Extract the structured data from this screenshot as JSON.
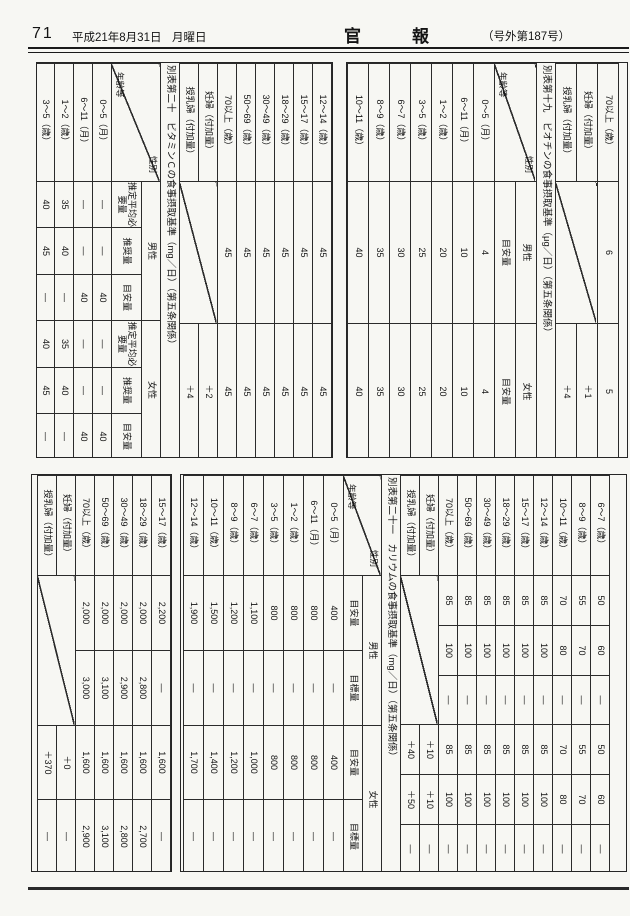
{
  "header": {
    "page_number": "71",
    "date": "平成21年8月31日",
    "weekday": "月曜日",
    "gazette_title": "官　　　報",
    "issue": "（号外第187号）"
  },
  "tables": {
    "pantothenic_tail": {
      "rows": [
        [
          "70以上（歳）",
          "6",
          "5"
        ],
        [
          "妊婦（付加量）",
          "DIAG",
          "＋1"
        ],
        [
          "授乳婦（付加量）",
          null,
          "＋4"
        ]
      ]
    },
    "biotin": {
      "title": "別表第十九　ビオチンの食事摂取基準（μg／日）（第五条関係）",
      "corner_top": "性別",
      "corner_bottom": "年齢等",
      "groups": [
        {
          "label": "男性",
          "cols": [
            "目安量"
          ]
        },
        {
          "label": "女性",
          "cols": [
            "目安量"
          ]
        }
      ],
      "part1_rows": [
        [
          "0～5（月）",
          "4",
          "4"
        ],
        [
          "6～11（月）",
          "10",
          "10"
        ],
        [
          "1～2（歳）",
          "20",
          "20"
        ],
        [
          "3～5（歳）",
          "25",
          "25"
        ],
        [
          "6～7（歳）",
          "30",
          "30"
        ],
        [
          "8～9（歳）",
          "35",
          "35"
        ],
        [
          "10～11（歳）",
          "40",
          "40"
        ]
      ],
      "part2_rows": [
        [
          "12～14（歳）",
          "45",
          "45"
        ],
        [
          "15～17（歳）",
          "45",
          "45"
        ],
        [
          "18～29（歳）",
          "45",
          "45"
        ],
        [
          "30～49（歳）",
          "45",
          "45"
        ],
        [
          "50～69（歳）",
          "45",
          "45"
        ],
        [
          "70以上（歳）",
          "45",
          "45"
        ],
        [
          "妊婦（付加量）",
          "DIAG",
          "＋2"
        ],
        [
          "授乳婦（付加量）",
          null,
          "＋4"
        ]
      ]
    },
    "vitamin_c": {
      "title": "別表第二十　ビタミンＣの食事摂取基準（mg／日）（第五条関係）",
      "corner_top": "性別",
      "corner_bottom": "年齢等",
      "groups": [
        {
          "label": "男性",
          "cols": [
            "推定平均必要量",
            "推奨量",
            "目安量"
          ]
        },
        {
          "label": "女性",
          "cols": [
            "推定平均必要量",
            "推奨量",
            "目安量"
          ]
        }
      ],
      "part1_rows": [
        [
          "0～5（月）",
          "—",
          "—",
          "40",
          "—",
          "—",
          "40"
        ],
        [
          "6～11（月）",
          "—",
          "—",
          "40",
          "—",
          "—",
          "40"
        ],
        [
          "1～2（歳）",
          "35",
          "40",
          "—",
          "35",
          "40",
          "—"
        ],
        [
          "3～5（歳）",
          "40",
          "45",
          "—",
          "40",
          "45",
          "—"
        ]
      ],
      "part2_rows": [
        [
          "6～7（歳）",
          "50",
          "60",
          "—",
          "50",
          "60",
          "—"
        ],
        [
          "8～9（歳）",
          "55",
          "70",
          "—",
          "55",
          "70",
          "—"
        ],
        [
          "10～11（歳）",
          "70",
          "80",
          "—",
          "70",
          "80",
          "—"
        ],
        [
          "12～14（歳）",
          "85",
          "100",
          "—",
          "85",
          "100",
          "—"
        ],
        [
          "15～17（歳）",
          "85",
          "100",
          "—",
          "85",
          "100",
          "—"
        ],
        [
          "18～29（歳）",
          "85",
          "100",
          "—",
          "85",
          "100",
          "—"
        ],
        [
          "30～49（歳）",
          "85",
          "100",
          "—",
          "85",
          "100",
          "—"
        ],
        [
          "50～69（歳）",
          "85",
          "100",
          "—",
          "85",
          "100",
          "—"
        ],
        [
          "70以上（歳）",
          "85",
          "100",
          "—",
          "85",
          "100",
          "—"
        ],
        [
          "妊婦（付加量）",
          "DIAG",
          "＋10",
          "＋10",
          "—"
        ],
        [
          "授乳婦（付加量）",
          null,
          "＋40",
          "＋50",
          "—"
        ]
      ]
    },
    "potassium": {
      "title": "別表第二十一　カリウムの食事摂取基準（mg／日）（第五条関係）",
      "corner_top": "性別",
      "corner_bottom": "年齢等",
      "groups": [
        {
          "label": "男性",
          "cols": [
            "目安量",
            "目標量"
          ]
        },
        {
          "label": "女性",
          "cols": [
            "目安量",
            "目標量"
          ]
        }
      ],
      "part1_rows": [
        [
          "0～5（月）",
          "400",
          "—",
          "400",
          "—"
        ],
        [
          "6～11（月）",
          "800",
          "—",
          "800",
          "—"
        ],
        [
          "1～2（歳）",
          "800",
          "—",
          "800",
          "—"
        ],
        [
          "3～5（歳）",
          "800",
          "—",
          "800",
          "—"
        ],
        [
          "6～7（歳）",
          "1,100",
          "—",
          "1,000",
          "—"
        ],
        [
          "8～9（歳）",
          "1,200",
          "—",
          "1,200",
          "—"
        ],
        [
          "10～11（歳）",
          "1,500",
          "—",
          "1,400",
          "—"
        ],
        [
          "12～14（歳）",
          "1,900",
          "—",
          "1,700",
          "—"
        ]
      ],
      "part2_rows": [
        [
          "15～17（歳）",
          "2,200",
          "—",
          "1,600",
          "—"
        ],
        [
          "18～29（歳）",
          "2,000",
          "2,800",
          "1,600",
          "2,700"
        ],
        [
          "30～49（歳）",
          "2,000",
          "2,900",
          "1,600",
          "2,800"
        ],
        [
          "50～69（歳）",
          "2,000",
          "3,100",
          "1,600",
          "3,100"
        ],
        [
          "70以上（歳）",
          "2,000",
          "3,000",
          "1,600",
          "2,900"
        ],
        [
          "妊婦（付加量）",
          "DIAG",
          "＋0",
          "—"
        ],
        [
          "授乳婦（付加量）",
          null,
          "＋370",
          "—"
        ]
      ]
    }
  }
}
